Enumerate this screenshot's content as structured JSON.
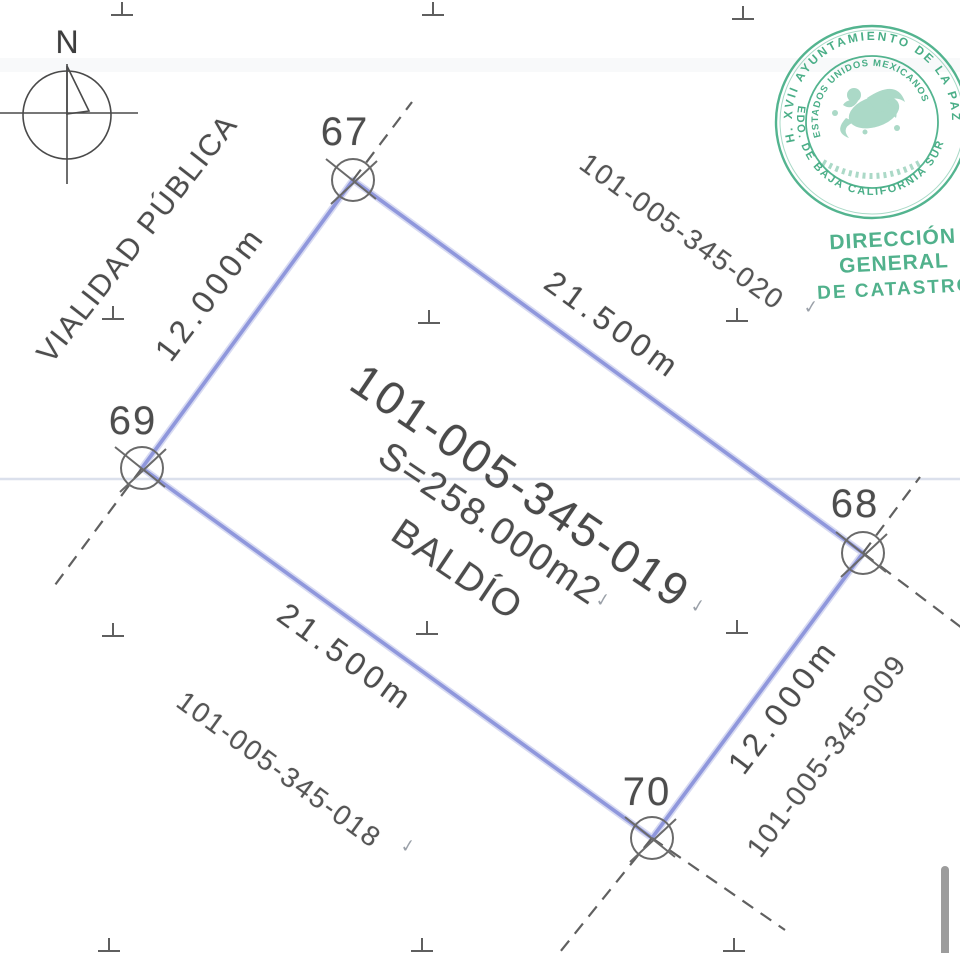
{
  "compass": {
    "north_label": "N"
  },
  "street": {
    "label": "VIALIDAD PÚBLICA"
  },
  "parcel": {
    "id": "101-005-345-019",
    "area": "S=258.000m2",
    "status": "BALDÍO",
    "vertices": {
      "v67": "67",
      "v68": "68",
      "v69": "69",
      "v70": "70"
    },
    "dimensions": {
      "top": "21.500m",
      "bottom": "21.500m",
      "left": "12.000m",
      "right": "12.000m"
    }
  },
  "neighbors": {
    "top_right": "101-005-345-020",
    "bottom_left": "101-005-345-018",
    "bottom_right": "101-005-345-009"
  },
  "stamp": {
    "outer_top": "H. XVII AYUNTAMIENTO DE LA PAZ",
    "outer_bottom": "EDO. DE BAJA CALIFORNIA SUR",
    "inner": "ESTADOS UNIDOS MEXICANOS",
    "office_line1": "DIRECCIÓN GENERAL",
    "office_line2": "DE CATASTRO"
  },
  "icons": {
    "checkmark": "✓"
  },
  "colors": {
    "boundary": "#8b94da",
    "ink": "#4d4d4d",
    "stamp_green": "#2ba173"
  }
}
